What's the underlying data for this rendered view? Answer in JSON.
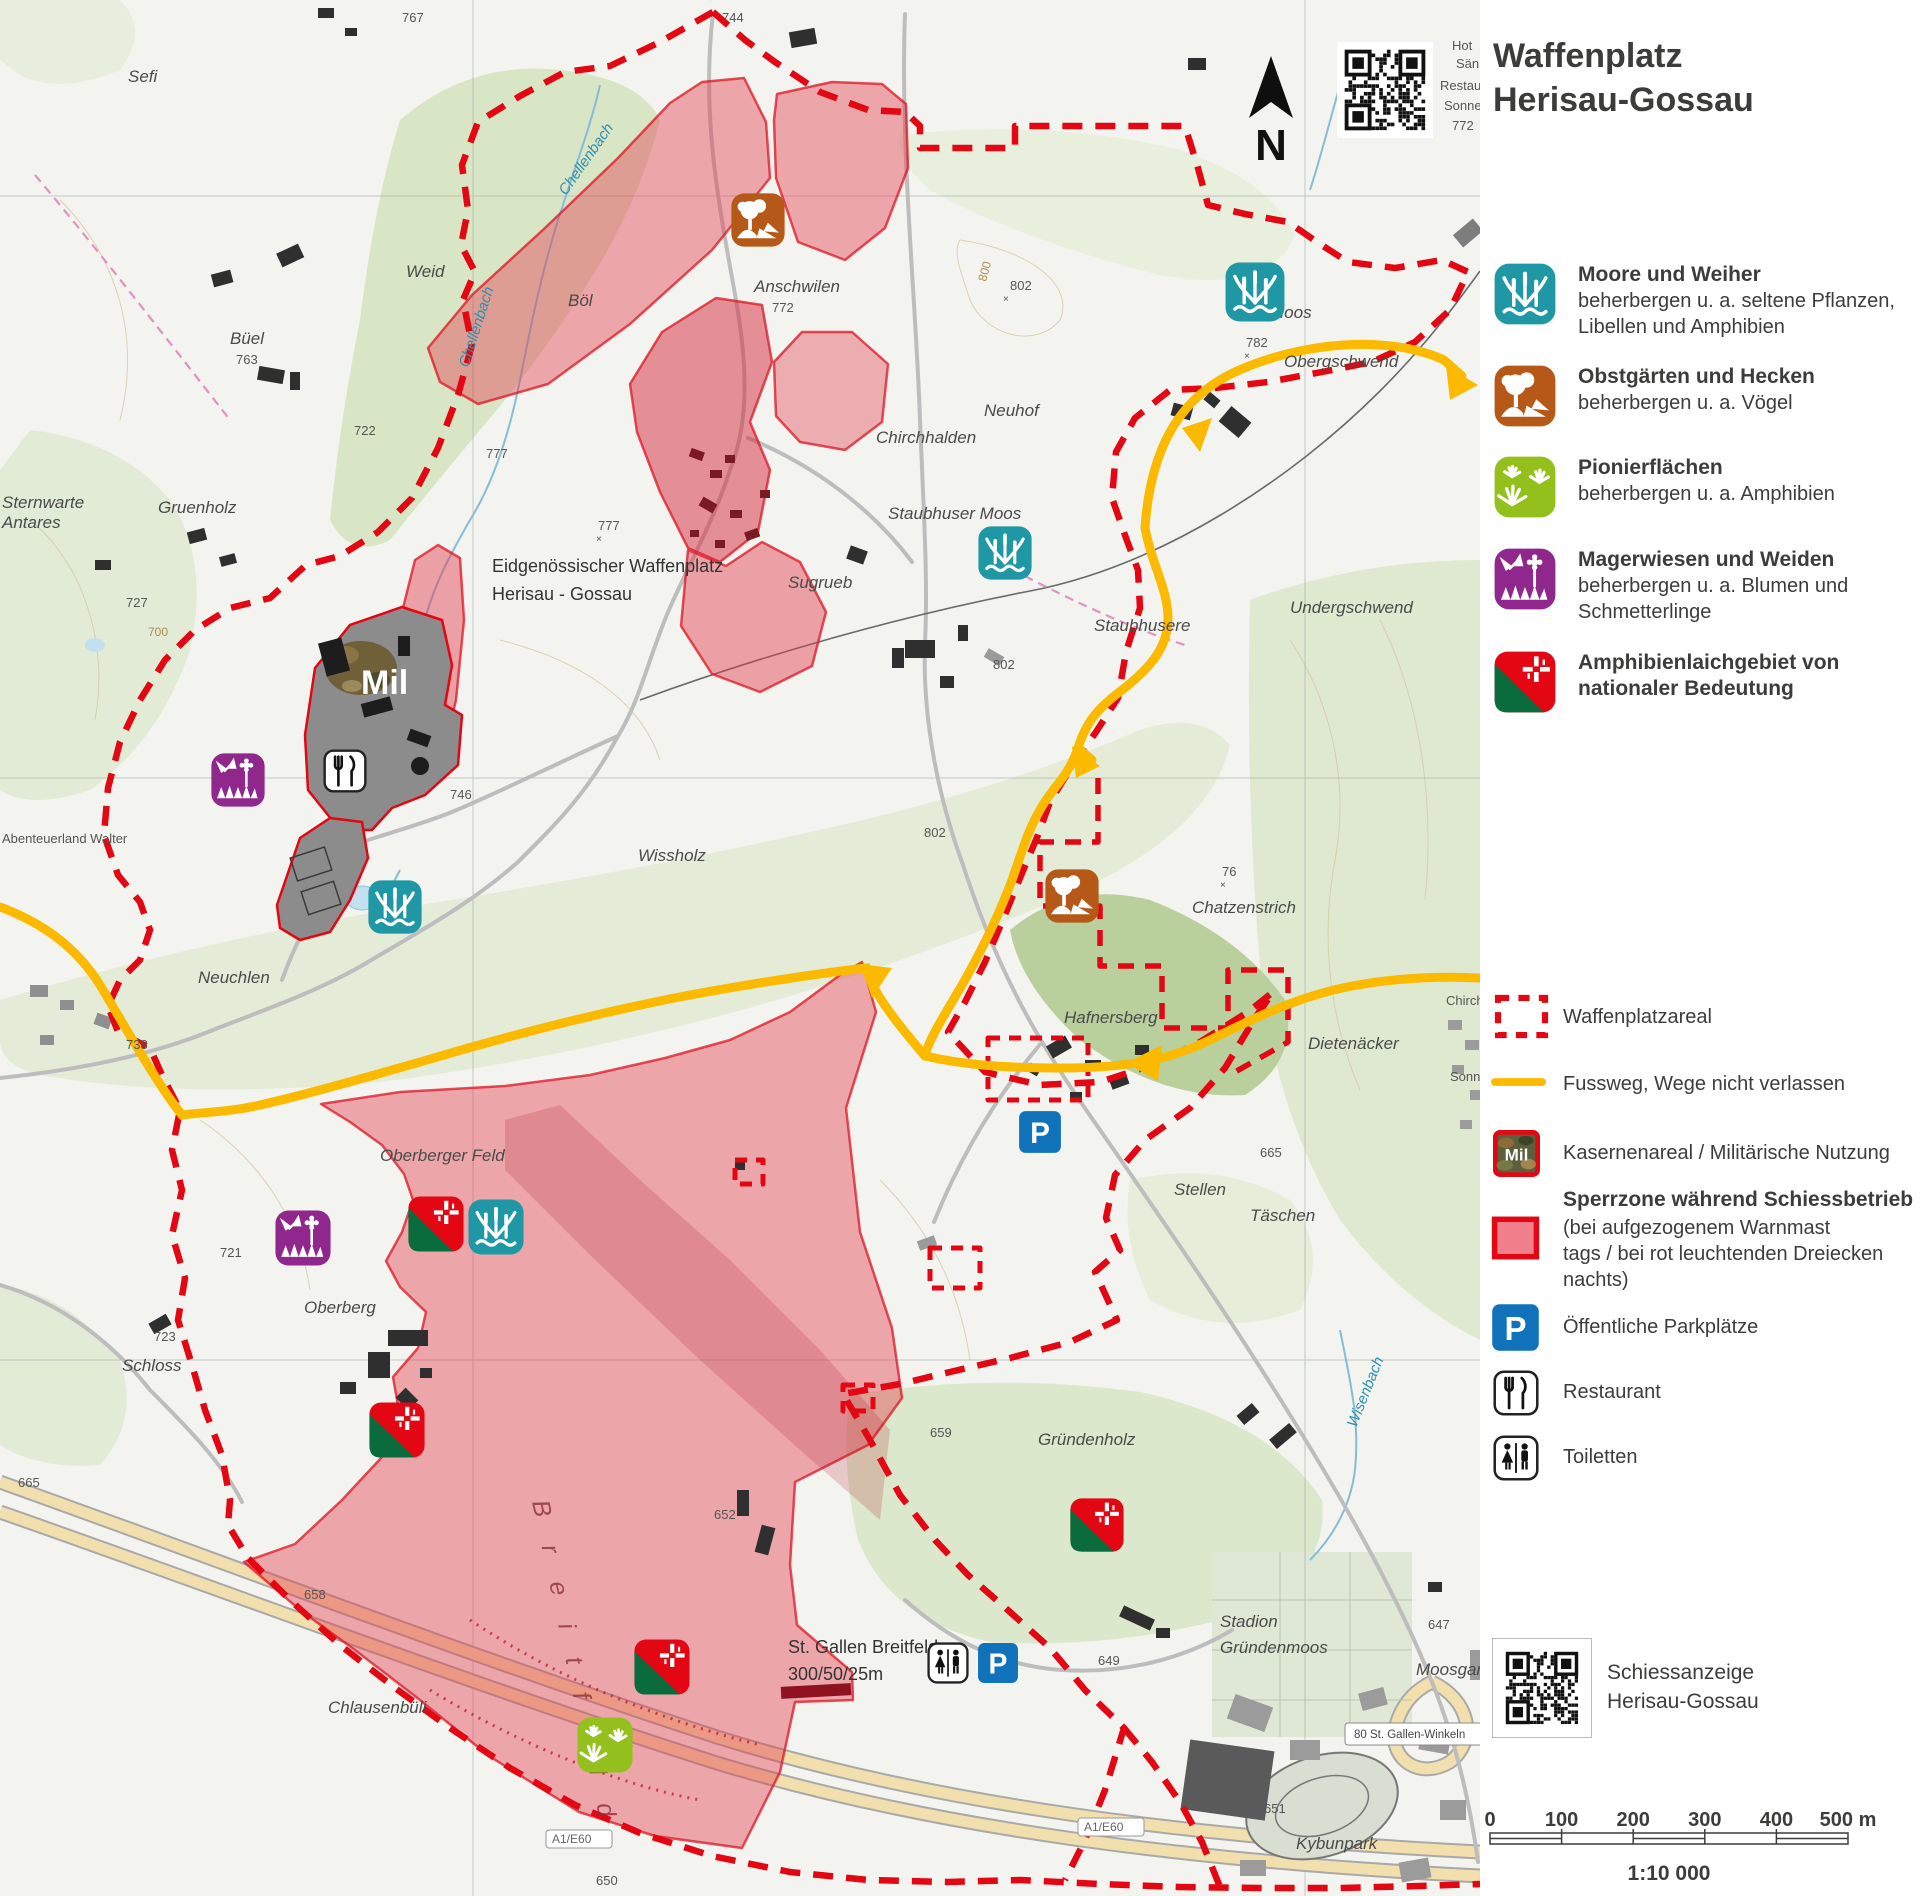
{
  "header": {
    "title_line1": "Waffenplatz",
    "title_line2": "Herisau-Gossau"
  },
  "colors": {
    "boundary_red": "#e30613",
    "zone_fill": "#e2394b",
    "footpath_yellow": "#fbba00",
    "moor_teal": "#1f97a5",
    "orchard_brown": "#b65817",
    "pioneer_green": "#93c01d",
    "meadow_purple": "#8f278c",
    "amph_green": "#0a6b3d",
    "parking_blue": "#1072ba",
    "text": "#3c3c3b"
  },
  "legend": {
    "biotopes": [
      {
        "icon": "moor",
        "title": "Moore und Weiher",
        "desc0": "beherbergen u. a. seltene Pflanzen,",
        "desc1": "Libellen und Amphibien"
      },
      {
        "icon": "orchard",
        "title": "Obstgärten und Hecken",
        "desc0": "beherbergen u. a. Vögel",
        "desc1": ""
      },
      {
        "icon": "pioneer",
        "title": "Pionierflächen",
        "desc0": "beherbergen u. a. Amphibien",
        "desc1": ""
      },
      {
        "icon": "meadow",
        "title": "Magerwiesen und Weiden",
        "desc0": "beherbergen u. a. Blumen und",
        "desc1": "Schmetterlinge"
      },
      {
        "icon": "amph",
        "title": "Amphibienlaichgebiet von",
        "desc0": "nationaler Bedeutung",
        "desc1": ""
      }
    ],
    "areal_label": "Waffenplatzareal",
    "footpath_label": "Fussweg, Wege nicht verlassen",
    "mil_label": "Kasernenareal / Militärische Nutzung",
    "sperrzone_title": "Sperrzone während Schiessbetrieb",
    "sperrzone_line1": "(bei aufgezogenem Warnmast",
    "sperrzone_line2": "tags / bei rot leuchtenden Dreiecken",
    "sperrzone_line3": "nachts)",
    "parking_label": "Öffentliche Parkplätze",
    "restaurant_label": "Restaurant",
    "toilets_label": "Toiletten",
    "qr_line1": "Schiessanzeige",
    "qr_line2": "Herisau-Gossau"
  },
  "scalebar": {
    "ticks": [
      "0",
      "100",
      "200",
      "300",
      "400",
      "500 m"
    ],
    "ratio": "1:10 000"
  },
  "map": {
    "compass_label": "N",
    "mil_area_label": "Mil",
    "labels": [
      {
        "t": "Sefi",
        "x": 128,
        "y": 82
      },
      {
        "t": "767",
        "x": 402,
        "y": 22,
        "c": "sm"
      },
      {
        "t": "744",
        "x": 722,
        "y": 22,
        "c": "sm"
      },
      {
        "t": "Weid",
        "x": 406,
        "y": 277
      },
      {
        "t": "Büel",
        "x": 230,
        "y": 344
      },
      {
        "t": "763",
        "x": 236,
        "y": 364,
        "c": "sm"
      },
      {
        "t": "Chellenbach",
        "x": 566,
        "y": 196,
        "c": "water",
        "r": -55
      },
      {
        "t": "Chellenbach",
        "x": 468,
        "y": 368,
        "c": "water",
        "r": -72
      },
      {
        "t": "Böl",
        "x": 568,
        "y": 306
      },
      {
        "t": "Anschwilen",
        "x": 754,
        "y": 292
      },
      {
        "t": "772",
        "x": 772,
        "y": 312,
        "c": "sm"
      },
      {
        "t": "800",
        "x": 986,
        "y": 282,
        "c": "contour",
        "r": -75
      },
      {
        "t": "802",
        "x": 1010,
        "y": 290,
        "c": "sm"
      },
      {
        "t": "×",
        "x": 1003,
        "y": 302,
        "c": "xs"
      },
      {
        "t": "Neuhof",
        "x": 984,
        "y": 416
      },
      {
        "t": "Chirchhalden",
        "x": 876,
        "y": 443
      },
      {
        "t": "Staubhuser Moos",
        "x": 888,
        "y": 519
      },
      {
        "t": "Moos",
        "x": 1270,
        "y": 318
      },
      {
        "t": "Sternwarte",
        "x": 2,
        "y": 508
      },
      {
        "t": "Antares",
        "x": 2,
        "y": 528
      },
      {
        "t": "Gruenholz",
        "x": 158,
        "y": 513
      },
      {
        "t": "727",
        "x": 126,
        "y": 607,
        "c": "sm"
      },
      {
        "t": "722",
        "x": 354,
        "y": 435,
        "c": "sm"
      },
      {
        "t": "777",
        "x": 598,
        "y": 530,
        "c": "sm"
      },
      {
        "t": "×",
        "x": 596,
        "y": 542,
        "c": "xs"
      },
      {
        "t": "777",
        "x": 486,
        "y": 458,
        "c": "sm"
      },
      {
        "t": "Eidgenössischer Waffenplatz",
        "x": 492,
        "y": 572,
        "c": "dark"
      },
      {
        "t": "Herisau - Gossau",
        "x": 492,
        "y": 600,
        "c": "dark"
      },
      {
        "t": "Sugrueb",
        "x": 788,
        "y": 588
      },
      {
        "t": "Staubhusere",
        "x": 1094,
        "y": 631
      },
      {
        "t": "Undergschwend",
        "x": 1290,
        "y": 613
      },
      {
        "t": "802",
        "x": 993,
        "y": 669,
        "c": "sm"
      },
      {
        "t": "746",
        "x": 450,
        "y": 799,
        "c": "sm"
      },
      {
        "t": "Wissholz",
        "x": 638,
        "y": 861
      },
      {
        "t": "Abenteuerland Walter",
        "x": 2,
        "y": 843,
        "c": "sm"
      },
      {
        "t": "700",
        "x": 148,
        "y": 636,
        "c": "contour"
      },
      {
        "t": "Neuchlen",
        "x": 198,
        "y": 983
      },
      {
        "t": "738",
        "x": 126,
        "y": 1049,
        "c": "sm"
      },
      {
        "t": "802",
        "x": 924,
        "y": 837,
        "c": "sm"
      },
      {
        "t": "Chatzenstrich",
        "x": 1192,
        "y": 913
      },
      {
        "t": "76",
        "x": 1222,
        "y": 876,
        "c": "sm"
      },
      {
        "t": "×",
        "x": 1220,
        "y": 888,
        "c": "xs"
      },
      {
        "t": "Hafnersberg",
        "x": 1064,
        "y": 1023
      },
      {
        "t": "Dietenäcker",
        "x": 1308,
        "y": 1049
      },
      {
        "t": "Chirch",
        "x": 1446,
        "y": 1005,
        "c": "sm"
      },
      {
        "t": "Sonn",
        "x": 1450,
        "y": 1081,
        "c": "sm"
      },
      {
        "t": "Oberberger Feld",
        "x": 380,
        "y": 1161
      },
      {
        "t": "721",
        "x": 220,
        "y": 1257,
        "c": "sm"
      },
      {
        "t": "Oberberg",
        "x": 304,
        "y": 1313
      },
      {
        "t": "Stellen",
        "x": 1174,
        "y": 1195
      },
      {
        "t": "Täschen",
        "x": 1250,
        "y": 1221
      },
      {
        "t": "665",
        "x": 1260,
        "y": 1157,
        "c": "sm"
      },
      {
        "t": "Schloss",
        "x": 122,
        "y": 1371
      },
      {
        "t": "723",
        "x": 154,
        "y": 1341,
        "c": "sm"
      },
      {
        "t": "665",
        "x": 18,
        "y": 1487,
        "c": "sm"
      },
      {
        "t": "658",
        "x": 304,
        "y": 1599,
        "c": "sm"
      },
      {
        "t": "Gründenholz",
        "x": 1038,
        "y": 1445
      },
      {
        "t": "659",
        "x": 930,
        "y": 1437,
        "c": "sm"
      },
      {
        "t": "649",
        "x": 1098,
        "y": 1665,
        "c": "sm"
      },
      {
        "t": "647",
        "x": 1428,
        "y": 1629,
        "c": "sm"
      },
      {
        "t": "Stadion",
        "x": 1220,
        "y": 1627
      },
      {
        "t": "Gründenmoos",
        "x": 1220,
        "y": 1653
      },
      {
        "t": "Moosgar",
        "x": 1416,
        "y": 1675
      },
      {
        "t": "Kybunpark",
        "x": 1296,
        "y": 1849
      },
      {
        "t": "St. Gallen Breitfeld",
        "x": 788,
        "y": 1653,
        "c": "dark"
      },
      {
        "t": "300/50/25m",
        "x": 788,
        "y": 1680,
        "c": "dark"
      },
      {
        "t": "Chlausenbüli",
        "x": 328,
        "y": 1713
      },
      {
        "t": "A1/E60",
        "x": 552,
        "y": 1843,
        "c": "roadlbl"
      },
      {
        "t": "A1/E60",
        "x": 1084,
        "y": 1831,
        "c": "roadlbl"
      },
      {
        "t": "650",
        "x": 596,
        "y": 1885,
        "c": "sm"
      },
      {
        "t": "651",
        "x": 1264,
        "y": 1813,
        "c": "sm"
      },
      {
        "t": "652",
        "x": 714,
        "y": 1519,
        "c": "sm"
      },
      {
        "t": "Wisenbach",
        "x": 1356,
        "y": 1428,
        "c": "water",
        "r": -68
      },
      {
        "t": "Hot",
        "x": 1452,
        "y": 50,
        "c": "sm"
      },
      {
        "t": "Sän",
        "x": 1456,
        "y": 68,
        "c": "sm"
      },
      {
        "t": "Restauran",
        "x": 1440,
        "y": 90,
        "c": "sm"
      },
      {
        "t": "Sonnenber",
        "x": 1444,
        "y": 110,
        "c": "sm"
      },
      {
        "t": "772",
        "x": 1452,
        "y": 130,
        "c": "sm"
      },
      {
        "t": "Obergschwend",
        "x": 1284,
        "y": 367
      },
      {
        "t": "782",
        "x": 1246,
        "y": 347,
        "c": "sm"
      },
      {
        "t": "×",
        "x": 1244,
        "y": 359,
        "c": "xs"
      },
      {
        "t": "80 St. Gallen-Winkeln",
        "x": 1354,
        "y": 1738,
        "c": "signlbl"
      },
      {
        "t": "B r e i t f e l d",
        "x": 532,
        "y": 1502,
        "c": "range",
        "r": 78
      },
      {
        "t": "Mil",
        "x": 361,
        "y": 694,
        "c": "mil"
      }
    ],
    "icons": [
      {
        "type": "moor",
        "x": 1255,
        "y": 292,
        "s": 62
      },
      {
        "type": "moor",
        "x": 1005,
        "y": 553,
        "s": 56
      },
      {
        "type": "moor",
        "x": 395,
        "y": 907,
        "s": 56
      },
      {
        "type": "moor",
        "x": 496,
        "y": 1227,
        "s": 58
      },
      {
        "type": "orchard",
        "x": 758,
        "y": 220,
        "s": 56
      },
      {
        "type": "orchard",
        "x": 1072,
        "y": 896,
        "s": 56
      },
      {
        "type": "pioneer",
        "x": 605,
        "y": 1745,
        "s": 58
      },
      {
        "type": "meadow",
        "x": 238,
        "y": 780,
        "s": 56
      },
      {
        "type": "meadow",
        "x": 303,
        "y": 1238,
        "s": 58
      },
      {
        "type": "amph",
        "x": 436,
        "y": 1224,
        "s": 58
      },
      {
        "type": "amph",
        "x": 397,
        "y": 1430,
        "s": 58
      },
      {
        "type": "amph",
        "x": 1097,
        "y": 1525,
        "s": 56
      },
      {
        "type": "amph",
        "x": 662,
        "y": 1667,
        "s": 58
      },
      {
        "type": "parking",
        "x": 1040,
        "y": 1132,
        "s": 44
      },
      {
        "type": "parking",
        "x": 998,
        "y": 1663,
        "s": 42
      },
      {
        "type": "toilets",
        "x": 948,
        "y": 1663,
        "s": 42
      },
      {
        "type": "restaurant",
        "x": 345,
        "y": 771,
        "s": 44
      }
    ]
  }
}
